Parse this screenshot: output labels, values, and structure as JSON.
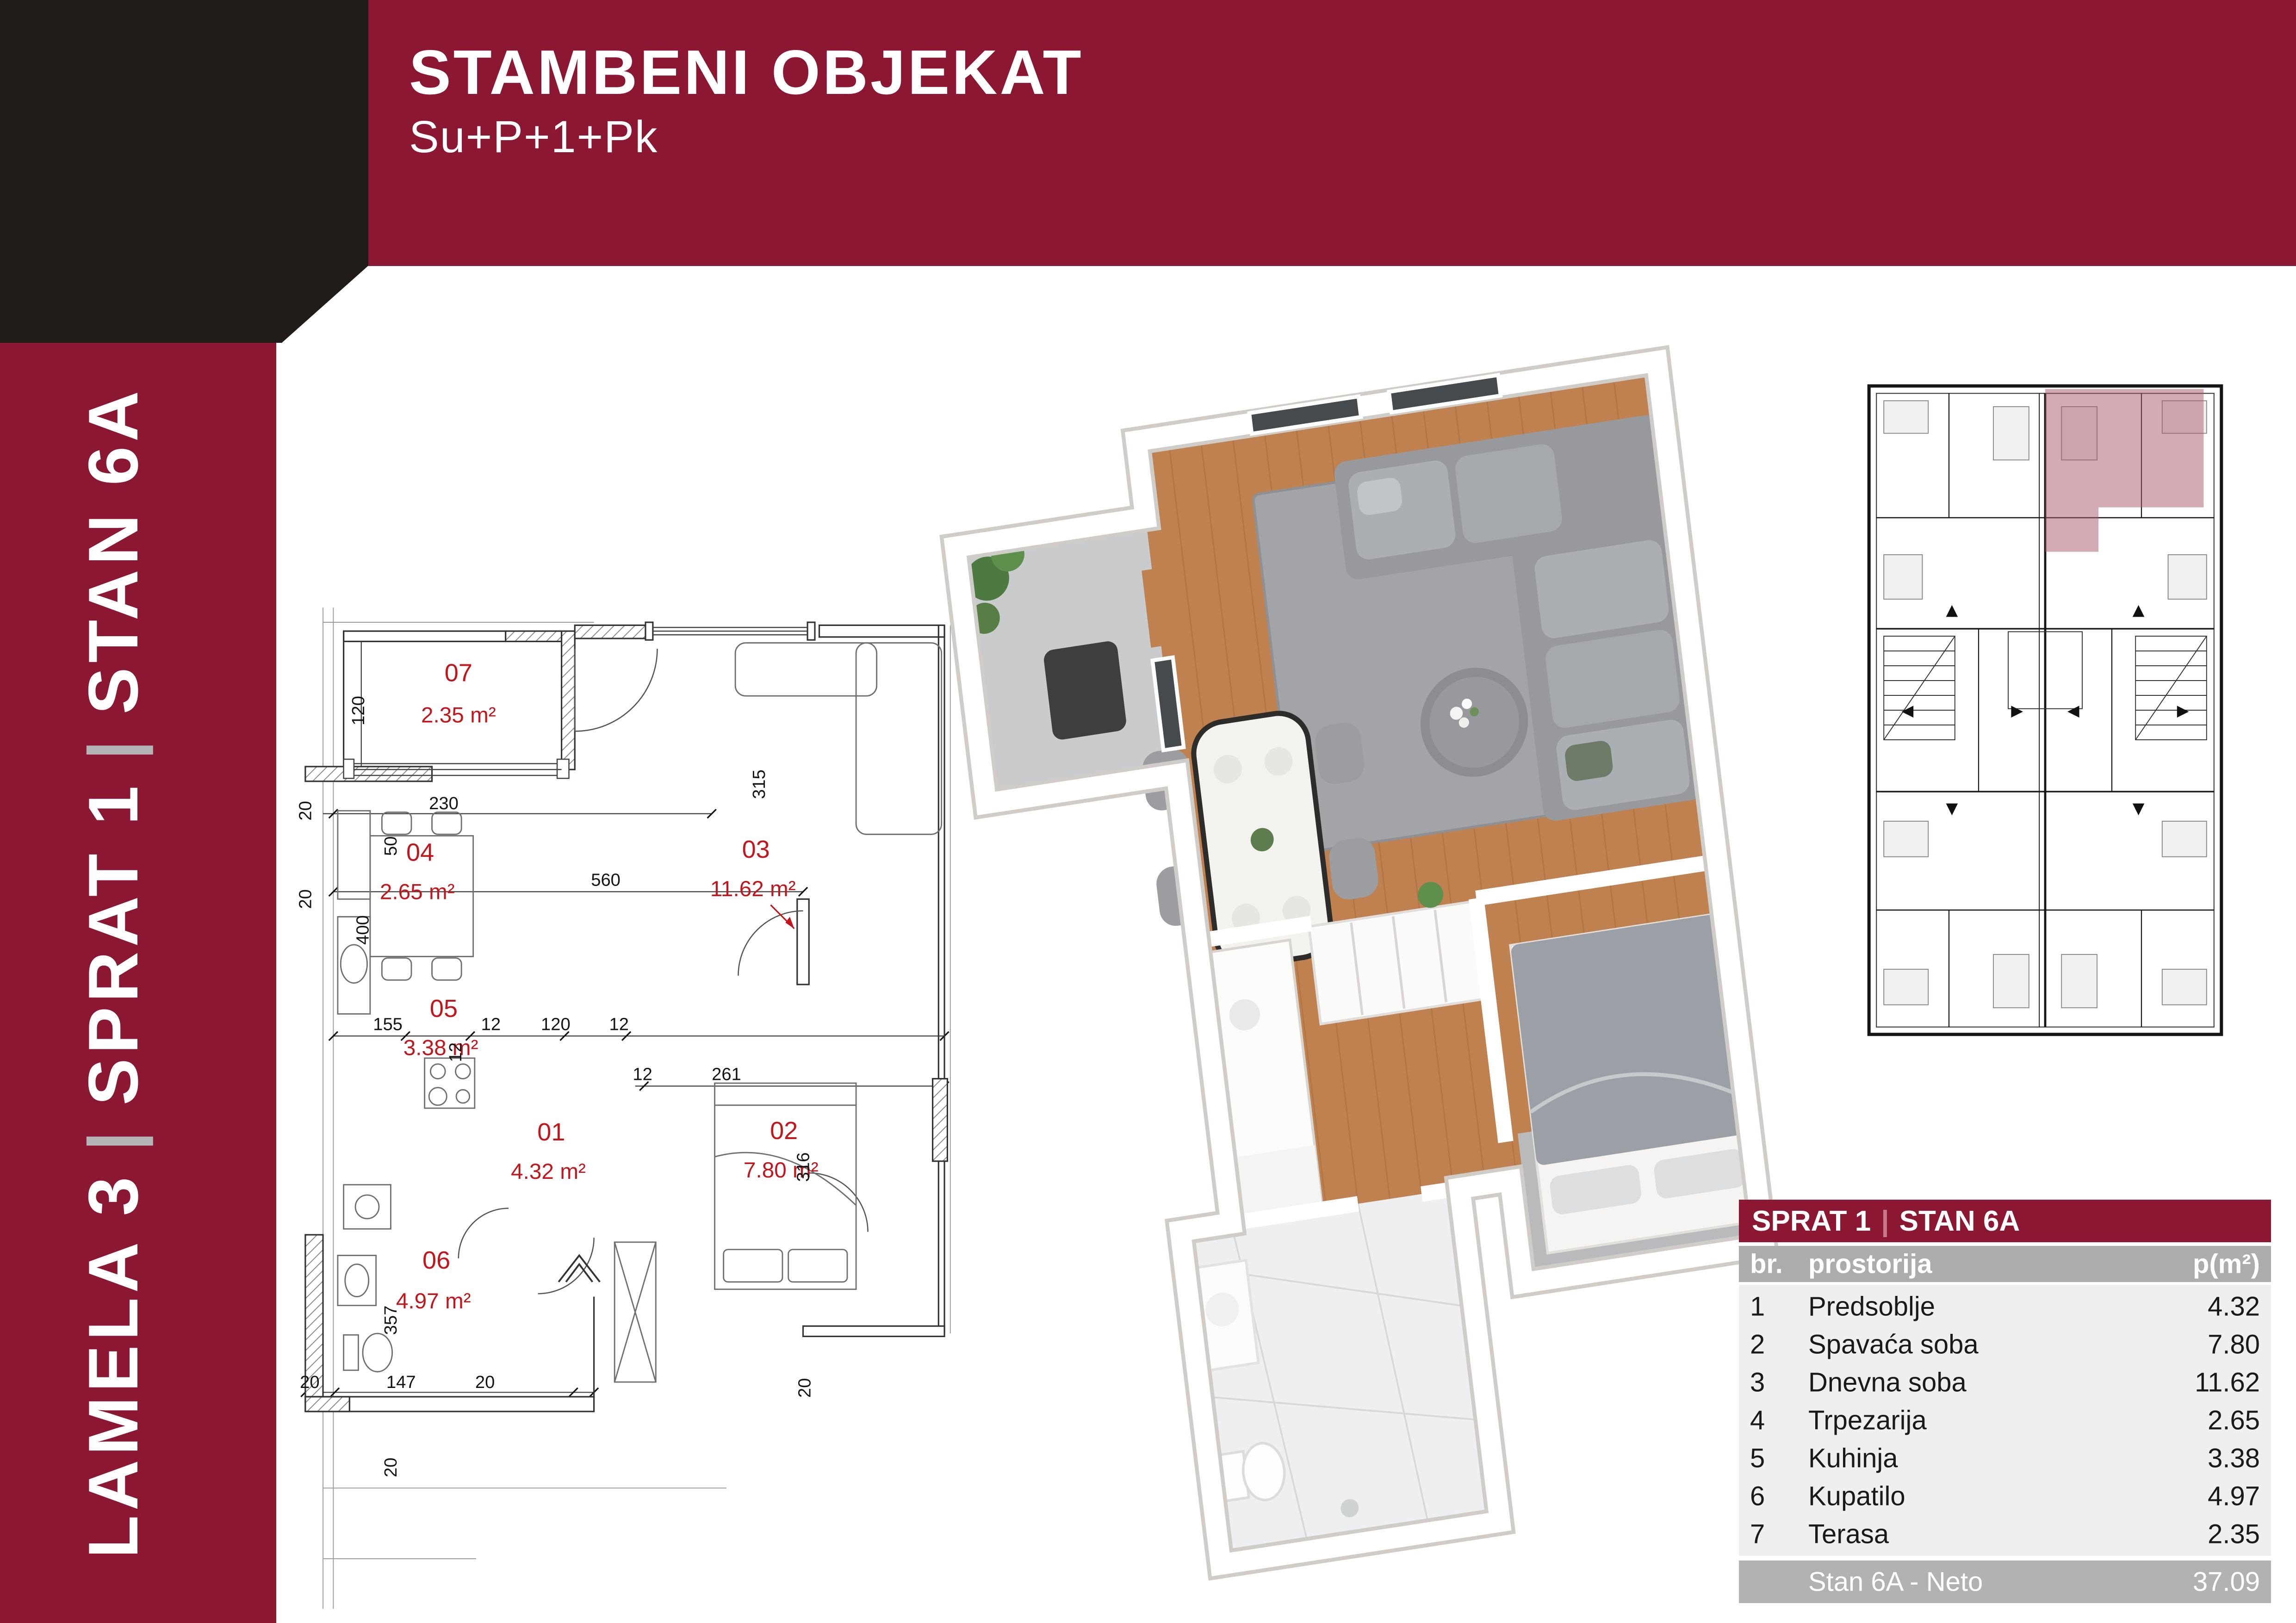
{
  "header": {
    "title": "STAMBENI OBJEKAT",
    "subtitle": "Su+P+1+Pk"
  },
  "sidebar": {
    "segments": [
      "LAMELA 3",
      "SPRAT 1",
      "STAN 6A"
    ],
    "separator": "|"
  },
  "colors": {
    "maroon": "#8C1733",
    "dark_block": "#211B19",
    "separator_gray": "#B3B4B6",
    "plan_red": "#C3161C",
    "wood_floor": "#BF8150",
    "highlight_rose": "#A85868",
    "table_colhead_bg": "#ACACAC",
    "table_row_bg": "#EFEFEF",
    "table_footer_bg": "#B2B2B2"
  },
  "floorplan": {
    "rooms": [
      {
        "num": "07",
        "area": "2.35 m²"
      },
      {
        "num": "03",
        "area": "11.62 m²"
      },
      {
        "num": "04",
        "area": "2.65 m²"
      },
      {
        "num": "05",
        "area": "3.38 m²"
      },
      {
        "num": "01",
        "area": "4.32 m²"
      },
      {
        "num": "02",
        "area": "7.80 m²"
      },
      {
        "num": "06",
        "area": "4.97 m²"
      }
    ],
    "dims": {
      "d120": "120",
      "d50": "50",
      "d20_t1": "20",
      "d230": "230",
      "d20_t2": "20",
      "d315": "315",
      "d560": "560",
      "d400": "400",
      "d155": "155",
      "d12_1": "12",
      "d120_2": "120",
      "d12_2": "12",
      "d261": "261",
      "d12_3": "12",
      "d12_4": "12",
      "d316": "316",
      "d20_bed": "20",
      "d357": "357",
      "d20_b1": "20",
      "d147": "147",
      "d20_b2": "20",
      "d20_b3": "20"
    }
  },
  "table": {
    "title_left": "SPRAT 1",
    "title_sep": "|",
    "title_right": "STAN 6A",
    "columns": {
      "num": "br.",
      "room": "prostorija",
      "area": "p(m²)"
    },
    "rows": [
      {
        "num": "1",
        "room": "Predsoblje",
        "area": "4.32"
      },
      {
        "num": "2",
        "room": "Spavaća soba",
        "area": "7.80"
      },
      {
        "num": "3",
        "room": "Dnevna soba",
        "area": "11.62"
      },
      {
        "num": "4",
        "room": "Trpezarija",
        "area": "2.65"
      },
      {
        "num": "5",
        "room": "Kuhinja",
        "area": "3.38"
      },
      {
        "num": "6",
        "room": "Kupatilo",
        "area": "4.97"
      },
      {
        "num": "7",
        "room": "Terasa",
        "area": "2.35"
      }
    ],
    "footer": {
      "label": "Stan 6A - Neto",
      "value": "37.09"
    }
  }
}
